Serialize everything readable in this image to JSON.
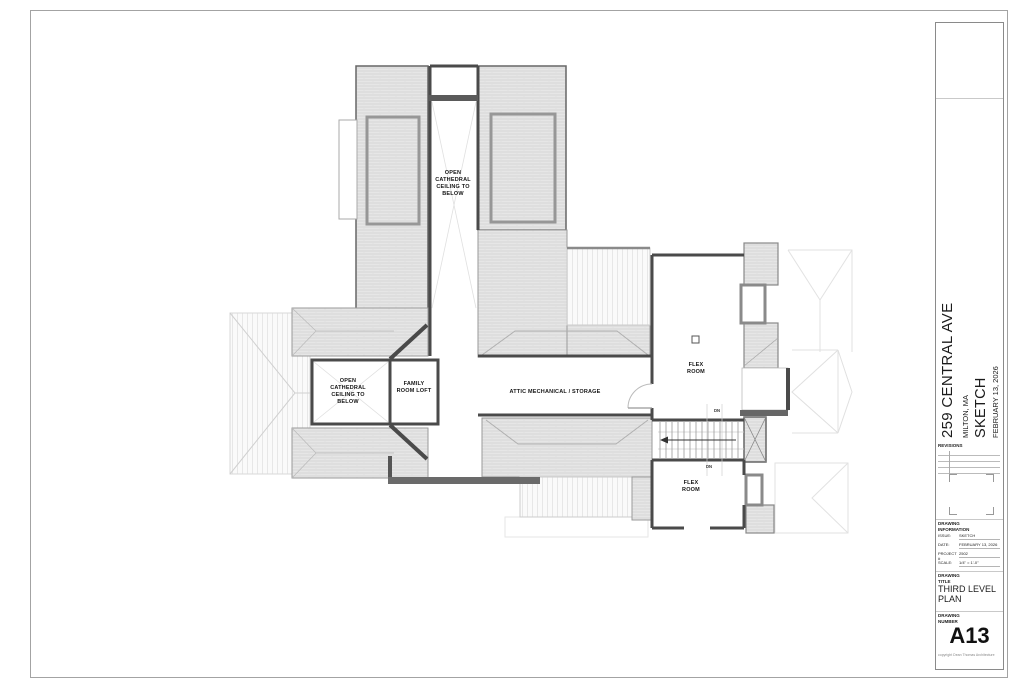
{
  "sheet": {
    "project": {
      "address": "259 CENTRAL AVE",
      "city": "MILTON, MA",
      "issue": "SKETCH",
      "date": "FEBRUARY 13, 2026"
    },
    "revision_heading": "REVISIONS",
    "drawing_information": {
      "heading": "DRAWING\nINFORMATION",
      "rows": [
        {
          "label": "ISSUE:",
          "value": "SKETCH"
        },
        {
          "label": "DATE:",
          "value": "FEBRUARY 13, 2026"
        },
        {
          "label": "PROJECT #",
          "value": "2502"
        },
        {
          "label": "SCALE:",
          "value": "1/4\" = 1'-0\""
        }
      ]
    },
    "drawing_title": {
      "heading": "DRAWING\nTITLE",
      "title": "THIRD LEVEL\nPLAN"
    },
    "drawing_number": {
      "heading": "DRAWING\nNUMBER",
      "number": "A13"
    },
    "copyright": "copyright Dean Thomas Architecture"
  },
  "plan": {
    "labels": {
      "open_cathedral_top": "OPEN\nCATHEDRAL\nCEILING TO\nBELOW",
      "open_cathedral_left": "OPEN\nCATHEDRAL\nCEILING TO\nBELOW",
      "family_room_loft": "FAMILY\nROOM LOFT",
      "attic": "ATTIC MECHANICAL / STORAGE",
      "flex_room_upper": "FLEX\nROOM",
      "flex_room_lower": "FLEX\nROOM",
      "dn_upper": "DN",
      "dn_lower": "DN"
    }
  },
  "colors": {
    "wall": "#4a4a4a",
    "roof_hatch_base": "#e6e6e6",
    "roof_hatch_line": "#d2d2d2",
    "light_outline": "#dddddd",
    "text": "#111111"
  }
}
